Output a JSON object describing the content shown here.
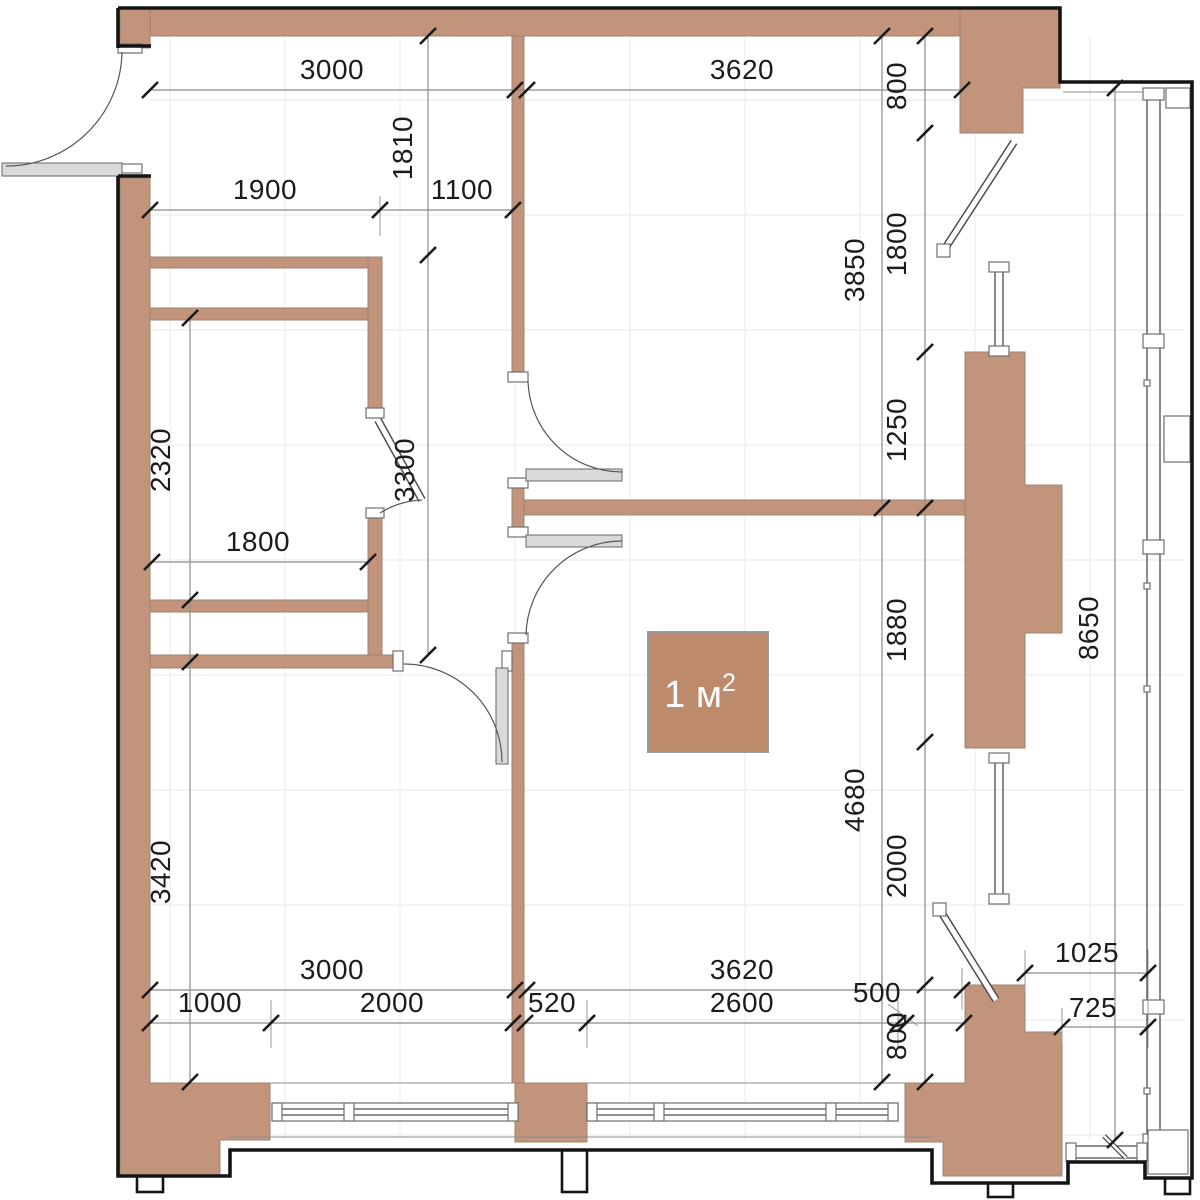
{
  "title": "Apartment floor plan with dimensions",
  "units": "mm",
  "colors": {
    "wall": "#c2947b",
    "area_fill": "#bd8a6c",
    "outline": "#141414",
    "dim_line": "#8c8c8c",
    "tick": "#1a1a1a",
    "text": "#1c1c1c",
    "door": "#d9d9d9",
    "background": "#ffffff"
  },
  "area_label": {
    "value": "1 м²",
    "base": "1 м",
    "sup": "2"
  },
  "dims": [
    {
      "value": "3000",
      "axis": "horizontal",
      "about": "top chain left room width"
    },
    {
      "value": "3620",
      "axis": "horizontal",
      "about": "top chain right room width"
    },
    {
      "value": "1900",
      "axis": "horizontal",
      "about": "closet zone width"
    },
    {
      "value": "1100",
      "axis": "horizontal",
      "about": "closet to hall wall"
    },
    {
      "value": "1810",
      "axis": "vertical",
      "about": "top wall to closet wall"
    },
    {
      "value": "3300",
      "axis": "vertical",
      "about": "closet wall to lower wall"
    },
    {
      "value": "2320",
      "axis": "vertical",
      "about": "closet room depth"
    },
    {
      "value": "1800",
      "axis": "horizontal",
      "about": "closet room width"
    },
    {
      "value": "3420",
      "axis": "vertical",
      "about": "bottom left room depth"
    },
    {
      "value": "3850",
      "axis": "vertical",
      "about": "top right room depth"
    },
    {
      "value": "800",
      "axis": "vertical",
      "about": "top right wall pier"
    },
    {
      "value": "1800",
      "axis": "vertical",
      "about": "balcony door opening"
    },
    {
      "value": "1250",
      "axis": "vertical",
      "about": "pier above middle wall"
    },
    {
      "value": "1880",
      "axis": "vertical",
      "about": "pier below middle wall"
    },
    {
      "value": "2000",
      "axis": "vertical",
      "about": "lower window opening"
    },
    {
      "value": "800",
      "axis": "vertical",
      "about": "bottom right wall pier"
    },
    {
      "value": "4680",
      "axis": "vertical",
      "about": "bottom right room depth"
    },
    {
      "value": "8650",
      "axis": "vertical",
      "about": "balcony length"
    },
    {
      "value": "3000",
      "axis": "horizontal",
      "about": "bottom chain left room width"
    },
    {
      "value": "3620",
      "axis": "horizontal",
      "about": "bottom chain right room width"
    },
    {
      "value": "1025",
      "axis": "horizontal",
      "about": "balcony width at top of chain"
    },
    {
      "value": "1000",
      "axis": "horizontal",
      "about": "pier left of window"
    },
    {
      "value": "2000",
      "axis": "horizontal",
      "about": "left window width"
    },
    {
      "value": "520",
      "axis": "horizontal",
      "about": "pier between windows"
    },
    {
      "value": "2600",
      "axis": "horizontal",
      "about": "right window width"
    },
    {
      "value": "500",
      "axis": "horizontal",
      "about": "pylon ledge width"
    },
    {
      "value": "725",
      "axis": "horizontal",
      "about": "balcony width at bottom"
    }
  ]
}
